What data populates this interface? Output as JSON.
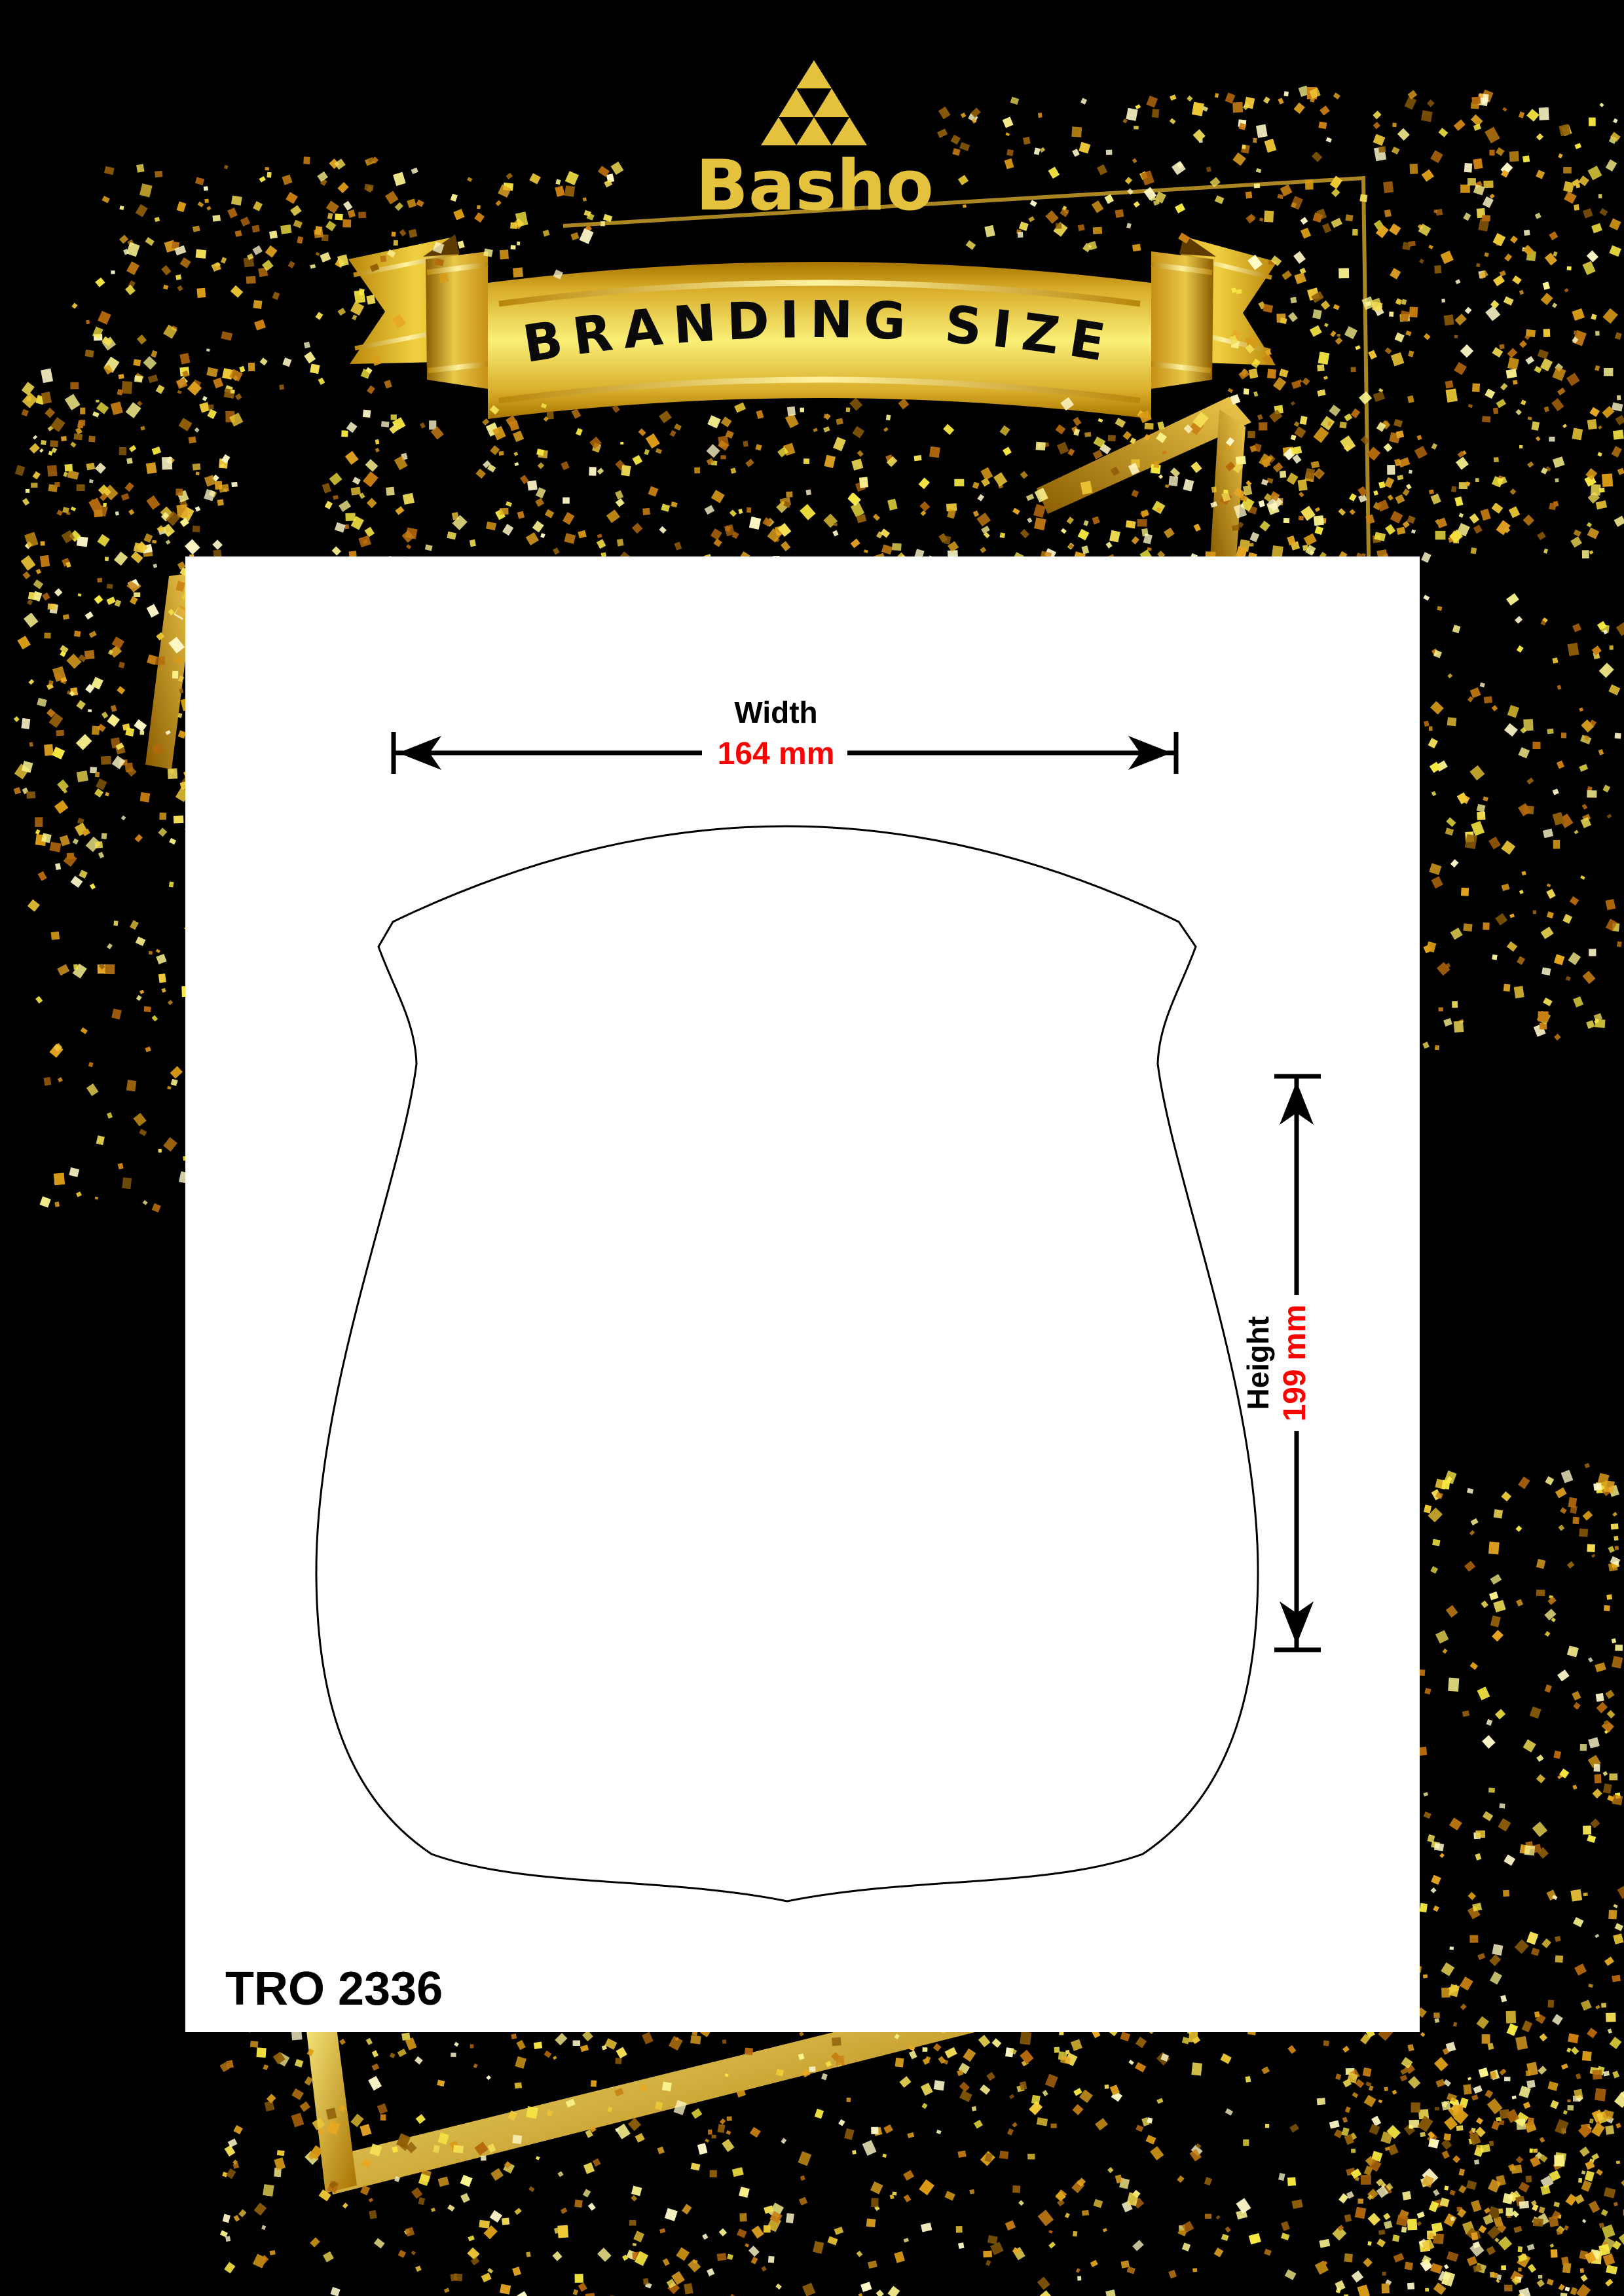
{
  "brand": {
    "name": "Basho"
  },
  "banner": {
    "title": "BRANDING SIZE"
  },
  "panel": {
    "product_code": "TRO 2336",
    "shape_name": "shield-plaque-outline"
  },
  "dimensions": {
    "width": {
      "label": "Width",
      "value": "164 mm"
    },
    "height": {
      "label": "Height",
      "value": "199 mm"
    }
  },
  "colors": {
    "background": "#000000",
    "panel": "#FFFFFF",
    "logo_gold": "#E4C23E",
    "ribbon_gold_bright": "#F9EF76",
    "ribbon_gold_deep": "#A87500",
    "frame_gold": "#D9AE2B",
    "dimension_value_red": "#FF0000",
    "line_black": "#000000"
  },
  "icons": {
    "logo": "triangle-mosaic-icon",
    "width_arrows": "double-headed-horizontal-arrow",
    "height_arrows": "double-headed-vertical-arrow"
  }
}
